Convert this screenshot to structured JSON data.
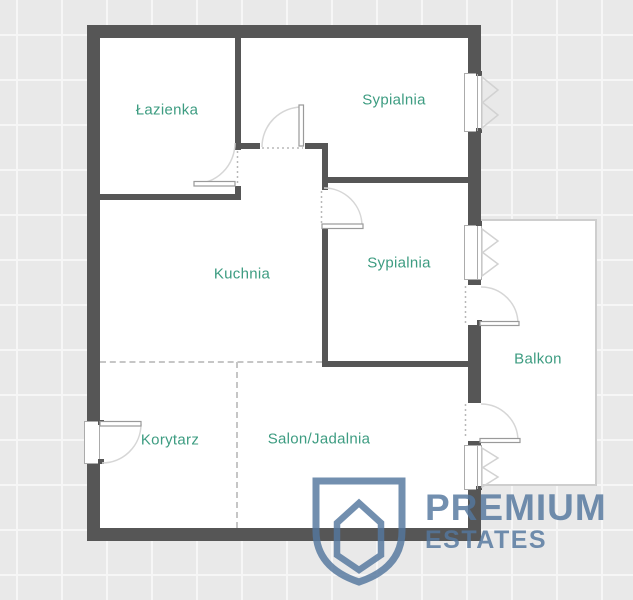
{
  "floorplan": {
    "rooms": [
      {
        "id": "lazienka",
        "label": "Łazienka"
      },
      {
        "id": "sypialnia-1",
        "label": "Sypialnia"
      },
      {
        "id": "sypialnia-2",
        "label": "Sypialnia"
      },
      {
        "id": "kuchnia",
        "label": "Kuchnia"
      },
      {
        "id": "korytarz",
        "label": "Korytarz"
      },
      {
        "id": "salon-jadalnia",
        "label": "Salon/Jadalnia"
      },
      {
        "id": "balkon",
        "label": "Balkon"
      }
    ]
  },
  "watermark": {
    "line1": "PREMIUM",
    "line2": "ESTATES"
  },
  "icons": {
    "shield": "shield-house-logo-icon",
    "windows": "casement-window-icon",
    "doors": "door-swing-icon"
  },
  "colors": {
    "background": "#e9e9e9",
    "grid_line": "#f6f6f6",
    "wall": "#565656",
    "room_label": "#3d9c81",
    "door_window_line": "#d6d6d6",
    "logo_blue": "#54779e"
  }
}
